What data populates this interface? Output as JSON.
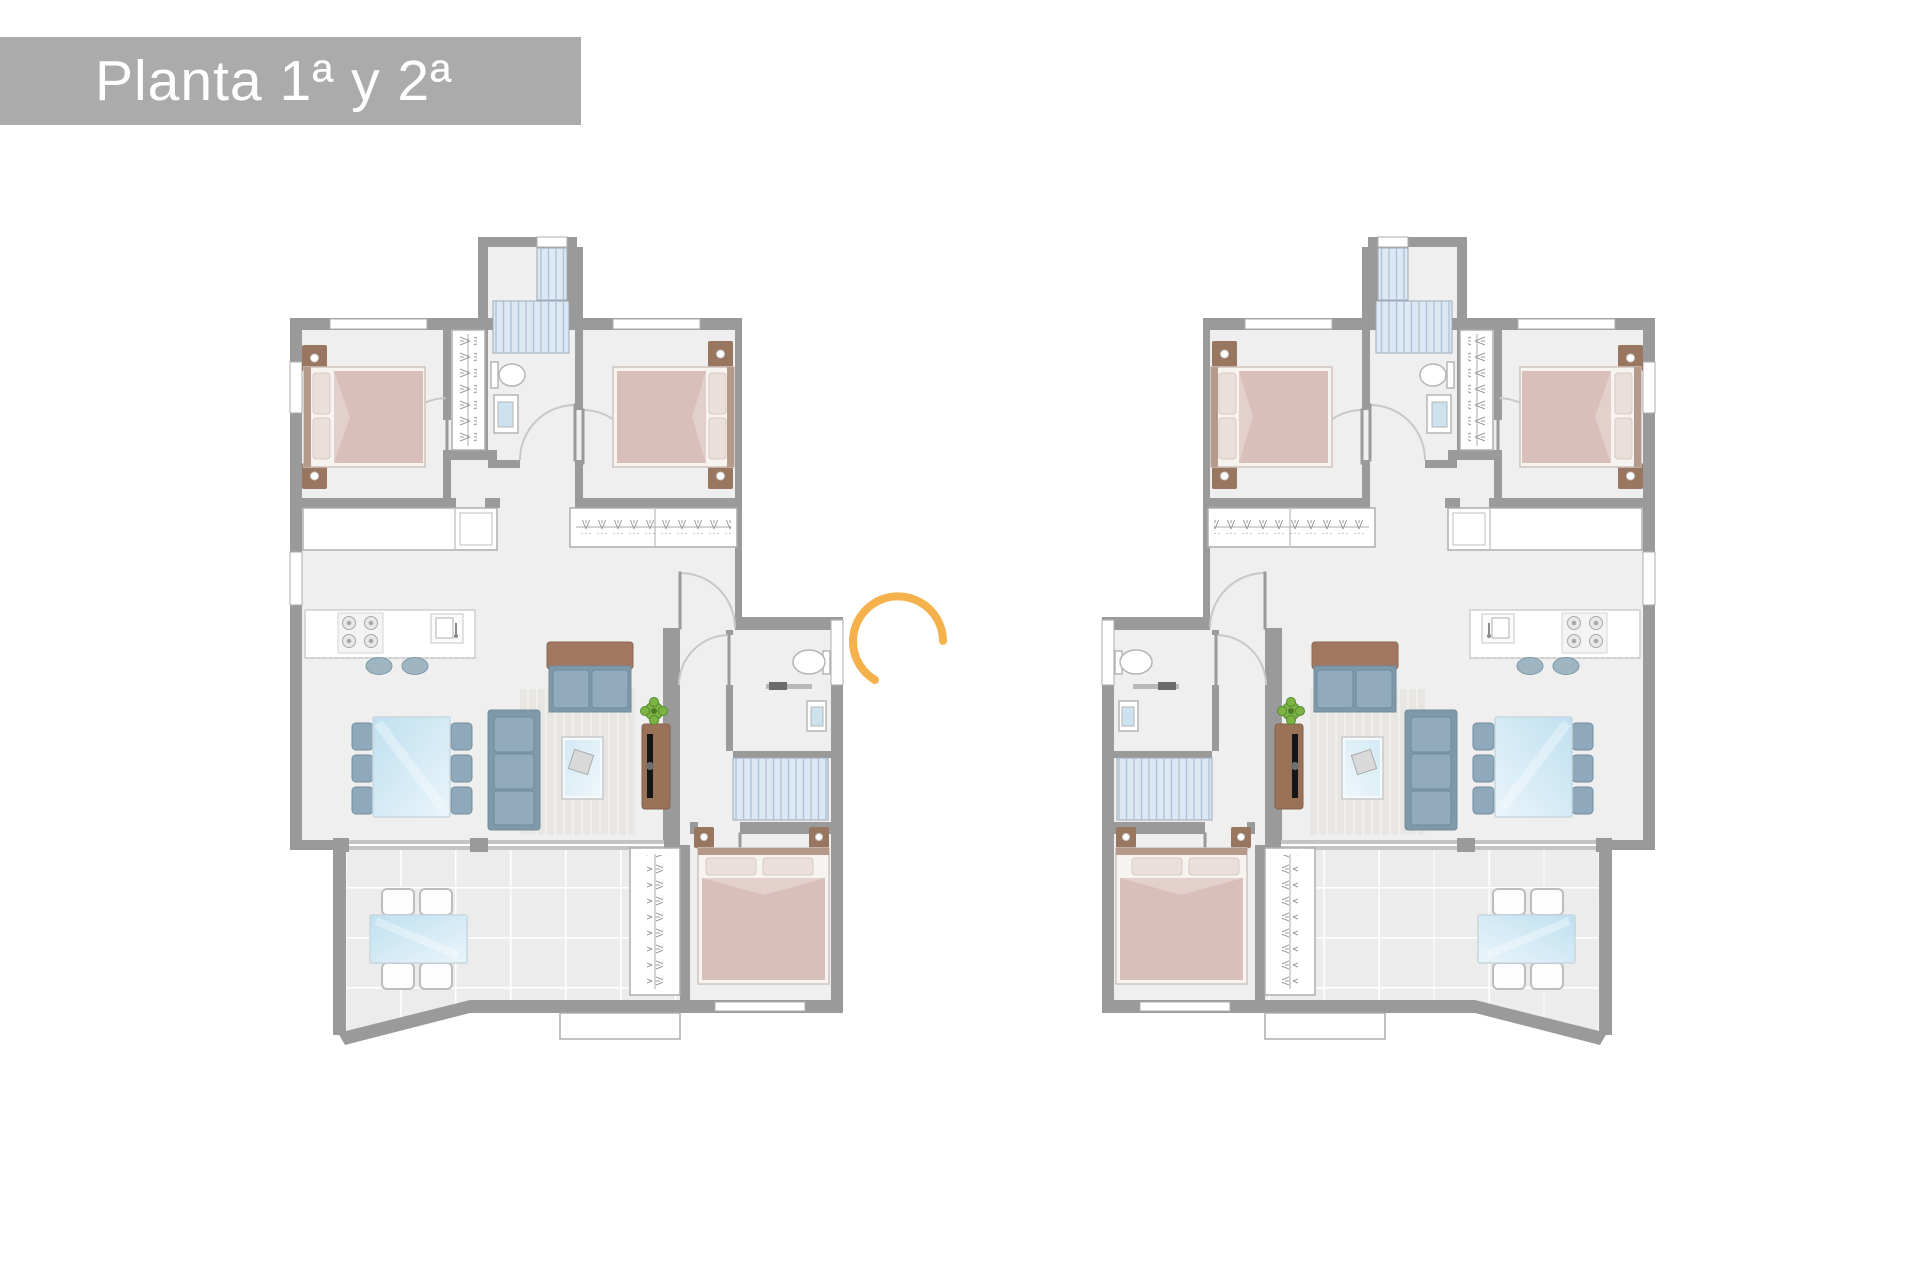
{
  "banner": {
    "label": "Planta 1ª y 2ª"
  },
  "plans": [
    {
      "id": "unit-left",
      "mirrored": false
    },
    {
      "id": "unit-right",
      "mirrored": true
    }
  ],
  "icons": {
    "spinner": "open-circle-arc",
    "plant": "top-view-plant",
    "stairs": "striped-treads"
  },
  "colors": {
    "banner_bg": "#ABABAB",
    "banner_text": "#FFFFFF",
    "wall": "#9A9A9A",
    "floor": "#EFEFEF",
    "terrace": "#ECECEC",
    "outline": "#ADADAD",
    "door_arc": "#C8C8C8",
    "door_leaf": "#9A9A9A",
    "stairs_bg": "#DDE8F2",
    "stairs_line": "#ADC3D9",
    "bed_body": "#D9BFBA",
    "bed_pillow": "#EBDFDB",
    "bed_frame": "#F7F3F1",
    "nightstand": "#997660",
    "sofa": "#91ABBC",
    "sofa_base": "#7F99A9",
    "sofa_dark": "#6F8C9D",
    "cushion_brown": "#A1775F",
    "chair": "#8FA9BA",
    "glass_deep": "#BFE0F0",
    "glass_light": "#EAF5FA",
    "tv_cab": "#9A7258",
    "tv": "#161616",
    "plant": "#7CB342",
    "plant_dark": "#558B2F",
    "rug": "#E7E6E3",
    "rug_line": "#F0EFEC",
    "sink_blue": "#CCE2EE",
    "fixture_line": "#B5B5B5",
    "spinner": "#F5B14B"
  }
}
